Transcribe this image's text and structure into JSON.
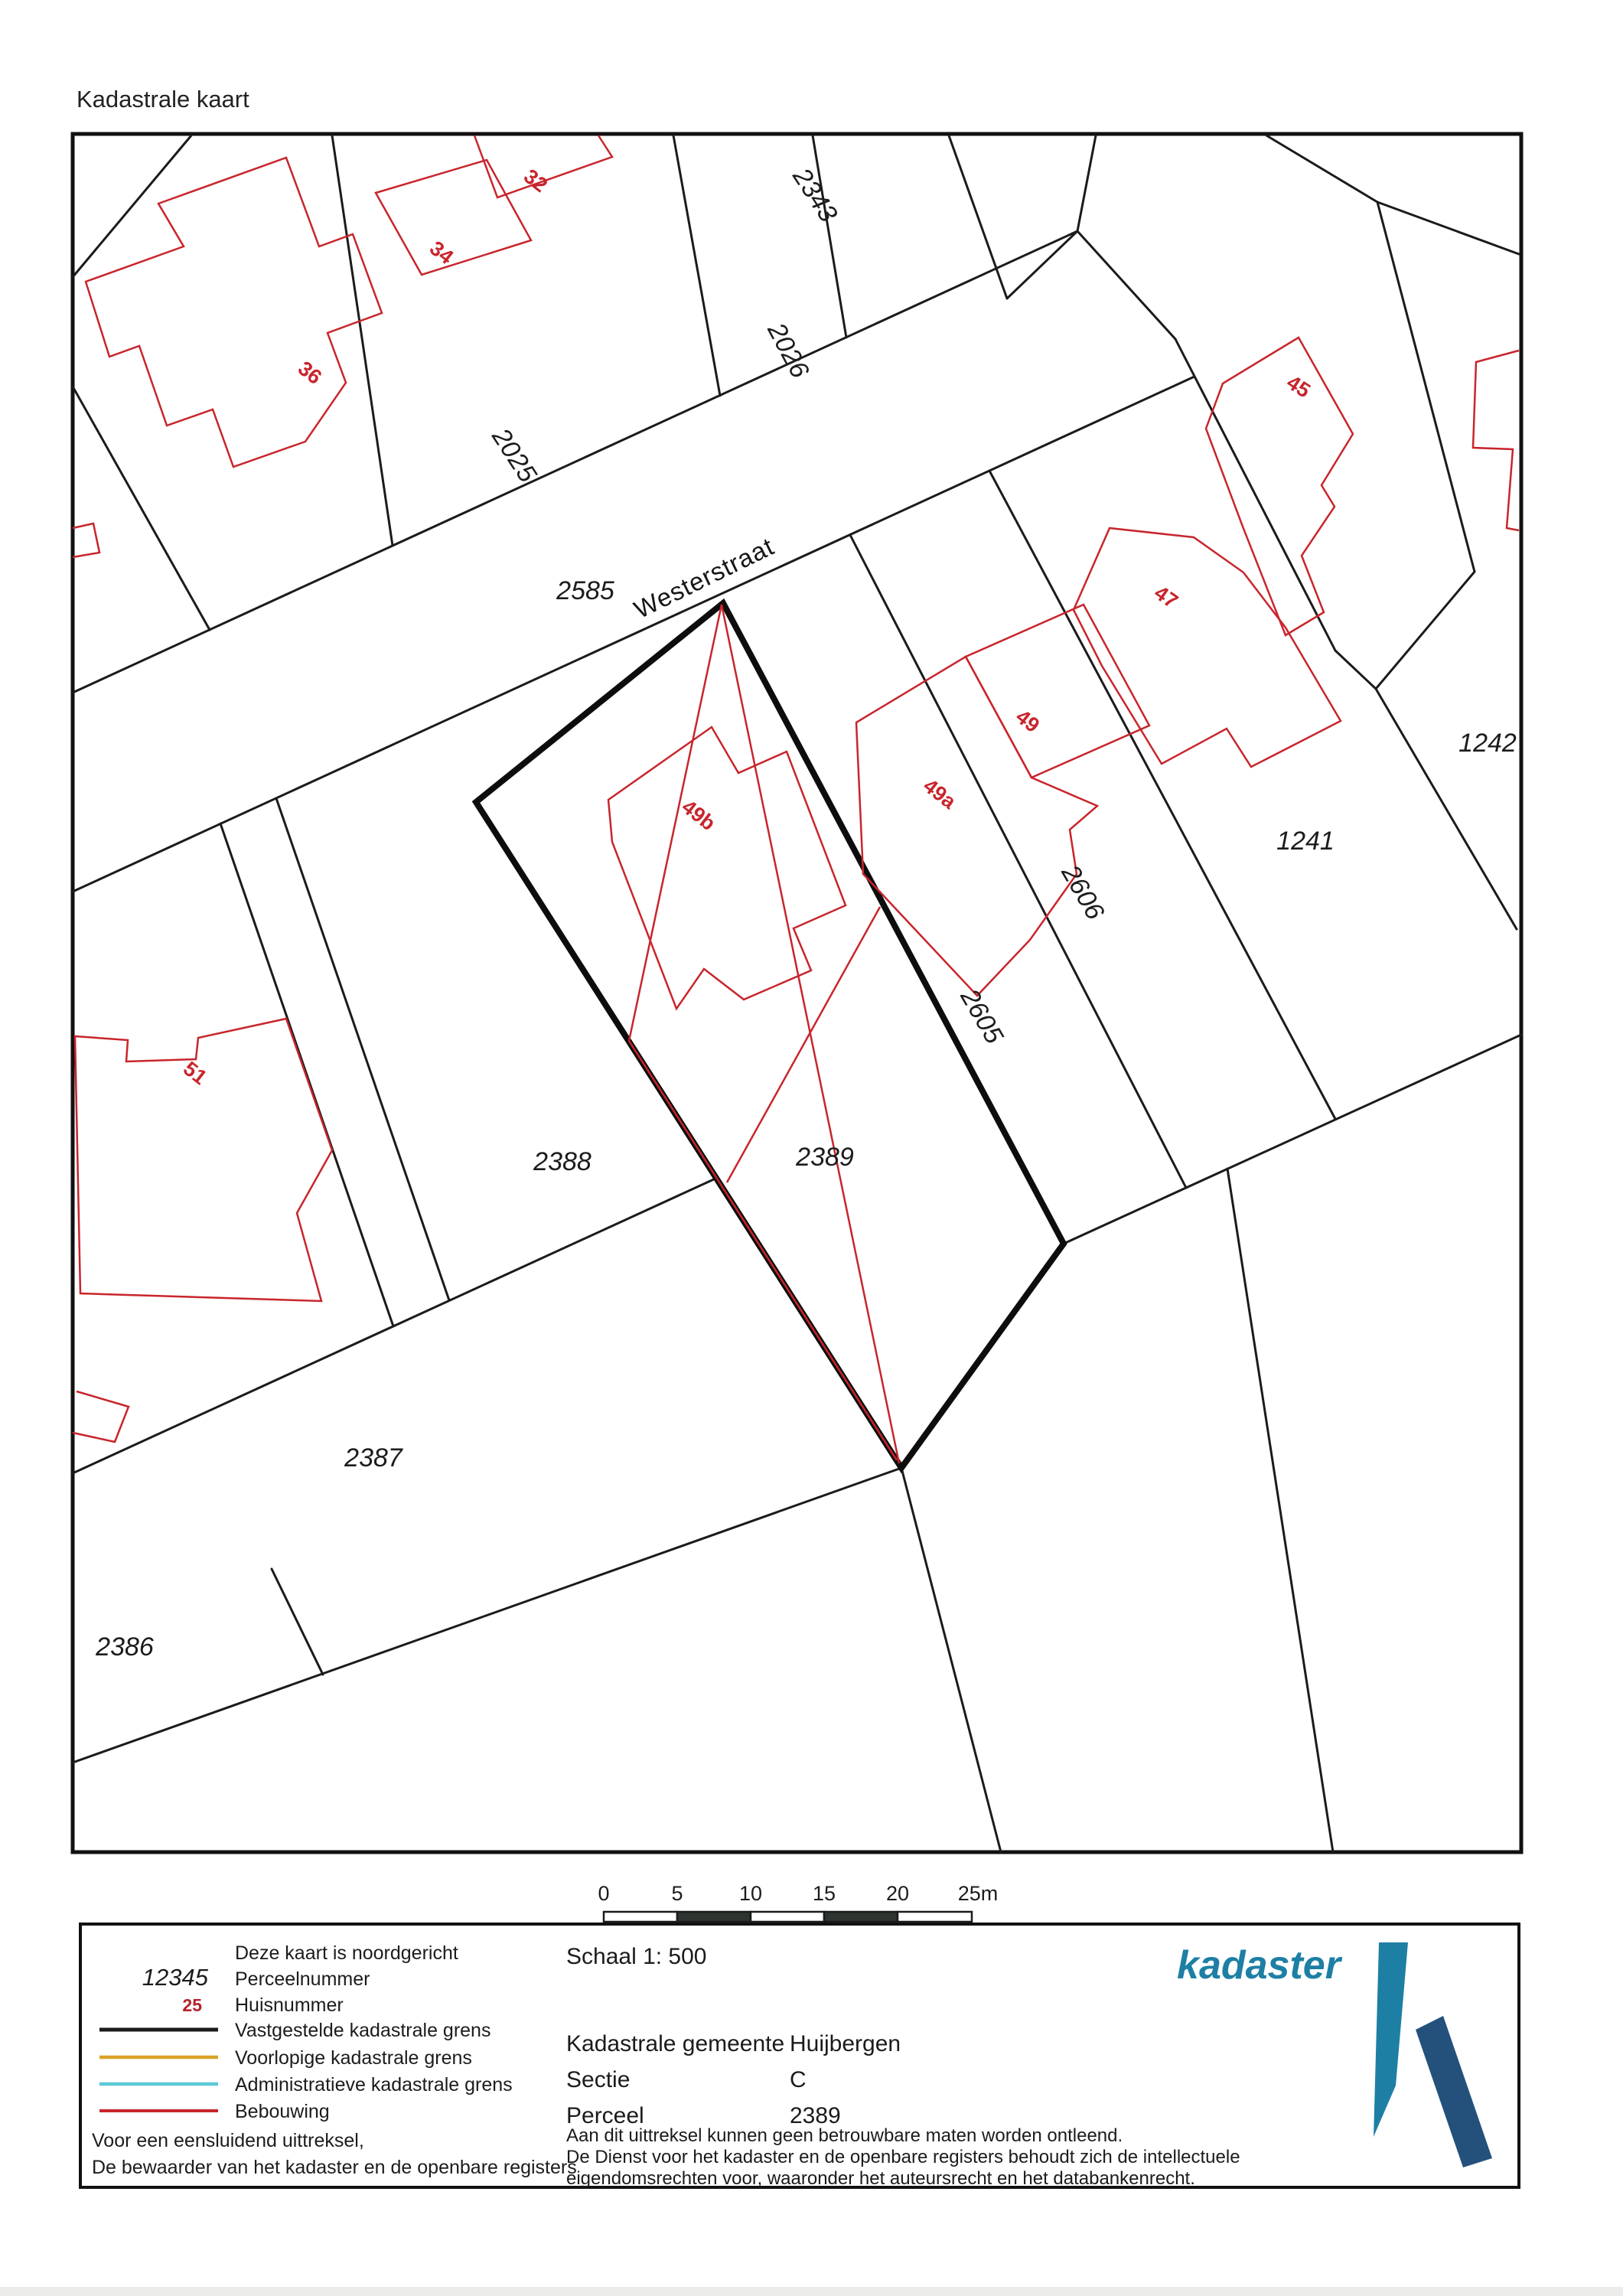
{
  "title": "Kadastrale kaart",
  "colors": {
    "boundary_black": "#1b1b1b",
    "building_red": "#c8252c",
    "legend_orange": "#dba227",
    "legend_cyan": "#5bc8d6",
    "scalebar_dark": "#2e342f",
    "logo_teal": "#1e7fa4",
    "logo_navy": "#24517c"
  },
  "map": {
    "street": {
      "text": "Westerstraat"
    },
    "parcel_labels": [
      {
        "text": "2343"
      },
      {
        "text": "2026"
      },
      {
        "text": "2025"
      },
      {
        "text": "2585"
      },
      {
        "text": "2389"
      },
      {
        "text": "2388"
      },
      {
        "text": "2387"
      },
      {
        "text": "2386"
      },
      {
        "text": "1241"
      },
      {
        "text": "1242"
      },
      {
        "text": "2606"
      },
      {
        "text": "2605"
      }
    ],
    "house_labels": [
      {
        "text": "32"
      },
      {
        "text": "34"
      },
      {
        "text": "36"
      },
      {
        "text": "45"
      },
      {
        "text": "47"
      },
      {
        "text": "49"
      },
      {
        "text": "49a"
      },
      {
        "text": "49b"
      },
      {
        "text": "51"
      }
    ]
  },
  "scalebar": {
    "ticks": [
      "0",
      "5",
      "10",
      "15",
      "20",
      "25m"
    ]
  },
  "legend": {
    "north_note": "Deze kaart is noordgericht",
    "items": [
      {
        "symbol": "12345",
        "label": "Perceelnummer"
      },
      {
        "symbol": "25",
        "label": "Huisnummer"
      },
      {
        "label": "Vastgestelde kadastrale grens"
      },
      {
        "label": "Voorlopige kadastrale grens"
      },
      {
        "label": "Administratieve kadastrale grens"
      },
      {
        "label": "Bebouwing"
      }
    ],
    "attest": [
      "Voor een eensluidend uittreksel,",
      "De bewaarder van het kadaster en de openbare registers"
    ]
  },
  "info": {
    "schaal": "Schaal 1: 500",
    "rows": [
      {
        "label": "Kadastrale gemeente",
        "value": "Huijbergen"
      },
      {
        "label": "Sectie",
        "value": "C"
      },
      {
        "label": "Perceel",
        "value": "2389"
      }
    ],
    "disclaimer": [
      "Aan dit uittreksel kunnen geen betrouwbare maten worden ontleend.",
      "De Dienst voor het kadaster en de openbare registers behoudt zich de intellectuele",
      "eigendomsrechten voor, waaronder het auteursrecht en het databankenrecht."
    ]
  },
  "logo": {
    "text": "kadaster"
  }
}
